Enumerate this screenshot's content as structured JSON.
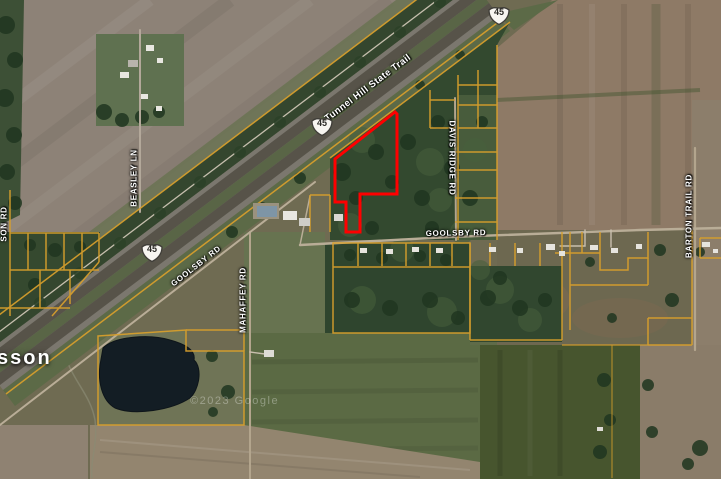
{
  "map": {
    "place_label": "sson",
    "watermark": "©2023 Google",
    "parcel_boundary_color": "#d9a02c",
    "highlighted_parcel": {
      "outline_color": "#ff0000",
      "points": "395,112 335,159 335,202 346,202 346,232 360,232 360,194 397,194 397,114"
    },
    "route_shields": [
      {
        "system": "US",
        "number": "45",
        "x": 499,
        "y": 15
      },
      {
        "system": "US",
        "number": "45",
        "x": 322,
        "y": 126
      },
      {
        "system": "US",
        "number": "45",
        "x": 152,
        "y": 252
      }
    ],
    "road_labels": [
      {
        "text": "Tunnel Hill State Trail",
        "x": 368,
        "y": 88,
        "rot": -37,
        "kind": "trail"
      },
      {
        "text": "BEASLEY LN",
        "x": 134,
        "y": 178,
        "rot": -90,
        "kind": "road"
      },
      {
        "text": "SON RD",
        "x": 4,
        "y": 224,
        "rot": -90,
        "kind": "road"
      },
      {
        "text": "GOOLSBY RD",
        "x": 196,
        "y": 266,
        "rot": -38,
        "kind": "road"
      },
      {
        "text": "MAHAFFEY RD",
        "x": 243,
        "y": 300,
        "rot": -90,
        "kind": "road"
      },
      {
        "text": "GOOLSBY RD",
        "x": 456,
        "y": 233,
        "rot": -1,
        "kind": "road"
      },
      {
        "text": "DAVIS RIDGE RD",
        "x": 452,
        "y": 158,
        "rot": 90,
        "kind": "road"
      },
      {
        "text": "BARTON TRAIL RD",
        "x": 689,
        "y": 216,
        "rot": -90,
        "kind": "road"
      }
    ]
  }
}
